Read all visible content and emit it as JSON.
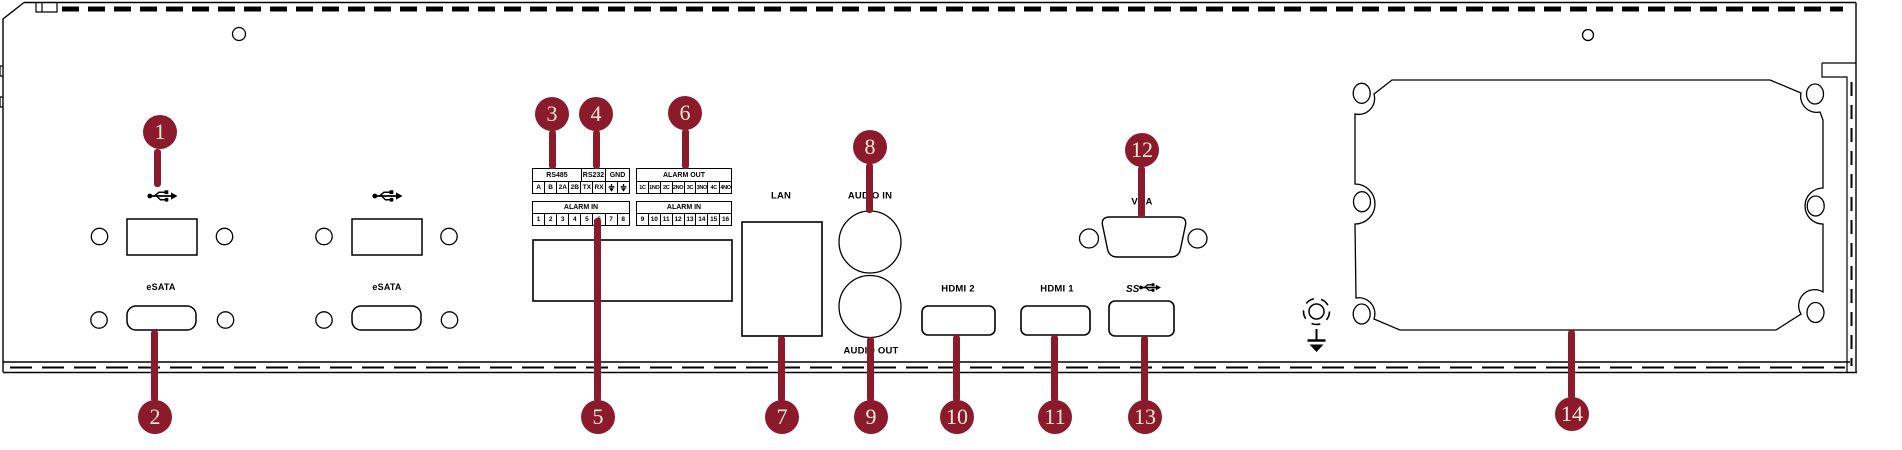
{
  "figure": {
    "callouts": [
      "1",
      "2",
      "3",
      "4",
      "5",
      "6",
      "7",
      "8",
      "9",
      "10",
      "11",
      "12",
      "13",
      "14"
    ]
  },
  "labels": {
    "esata": "eSATA",
    "lan": "LAN",
    "audio_in": "AUDIO IN",
    "audio_out": "AUDIO OUT",
    "hdmi2": "HDMI 2",
    "hdmi1": "HDMI 1",
    "vga": "VGA",
    "superspeed": "SS"
  },
  "terminal": {
    "rs485": "RS485",
    "rs232": "RS232",
    "gnd": "GND",
    "serial_cells": [
      "A",
      "B",
      "2A",
      "2B",
      "TX",
      "RX"
    ],
    "alarm_in_left_label": "ALARM IN",
    "alarm_in_left_cells": [
      "1",
      "2",
      "3",
      "4",
      "5",
      "6",
      "7",
      "8"
    ],
    "alarm_out_label": "ALARM OUT",
    "alarm_out_cells": [
      "1C",
      "1NO",
      "2C",
      "2NO",
      "3C",
      "3NO",
      "4C",
      "4NO"
    ],
    "alarm_in_right_label": "ALARM IN",
    "alarm_in_right_cells": [
      "9",
      "10",
      "11",
      "12",
      "13",
      "14",
      "15",
      "16"
    ]
  },
  "colors": {
    "callout": "#8B1A2B",
    "callout_text": "#F4ECD9",
    "line": "#000000",
    "background": "#FFFFFF"
  }
}
